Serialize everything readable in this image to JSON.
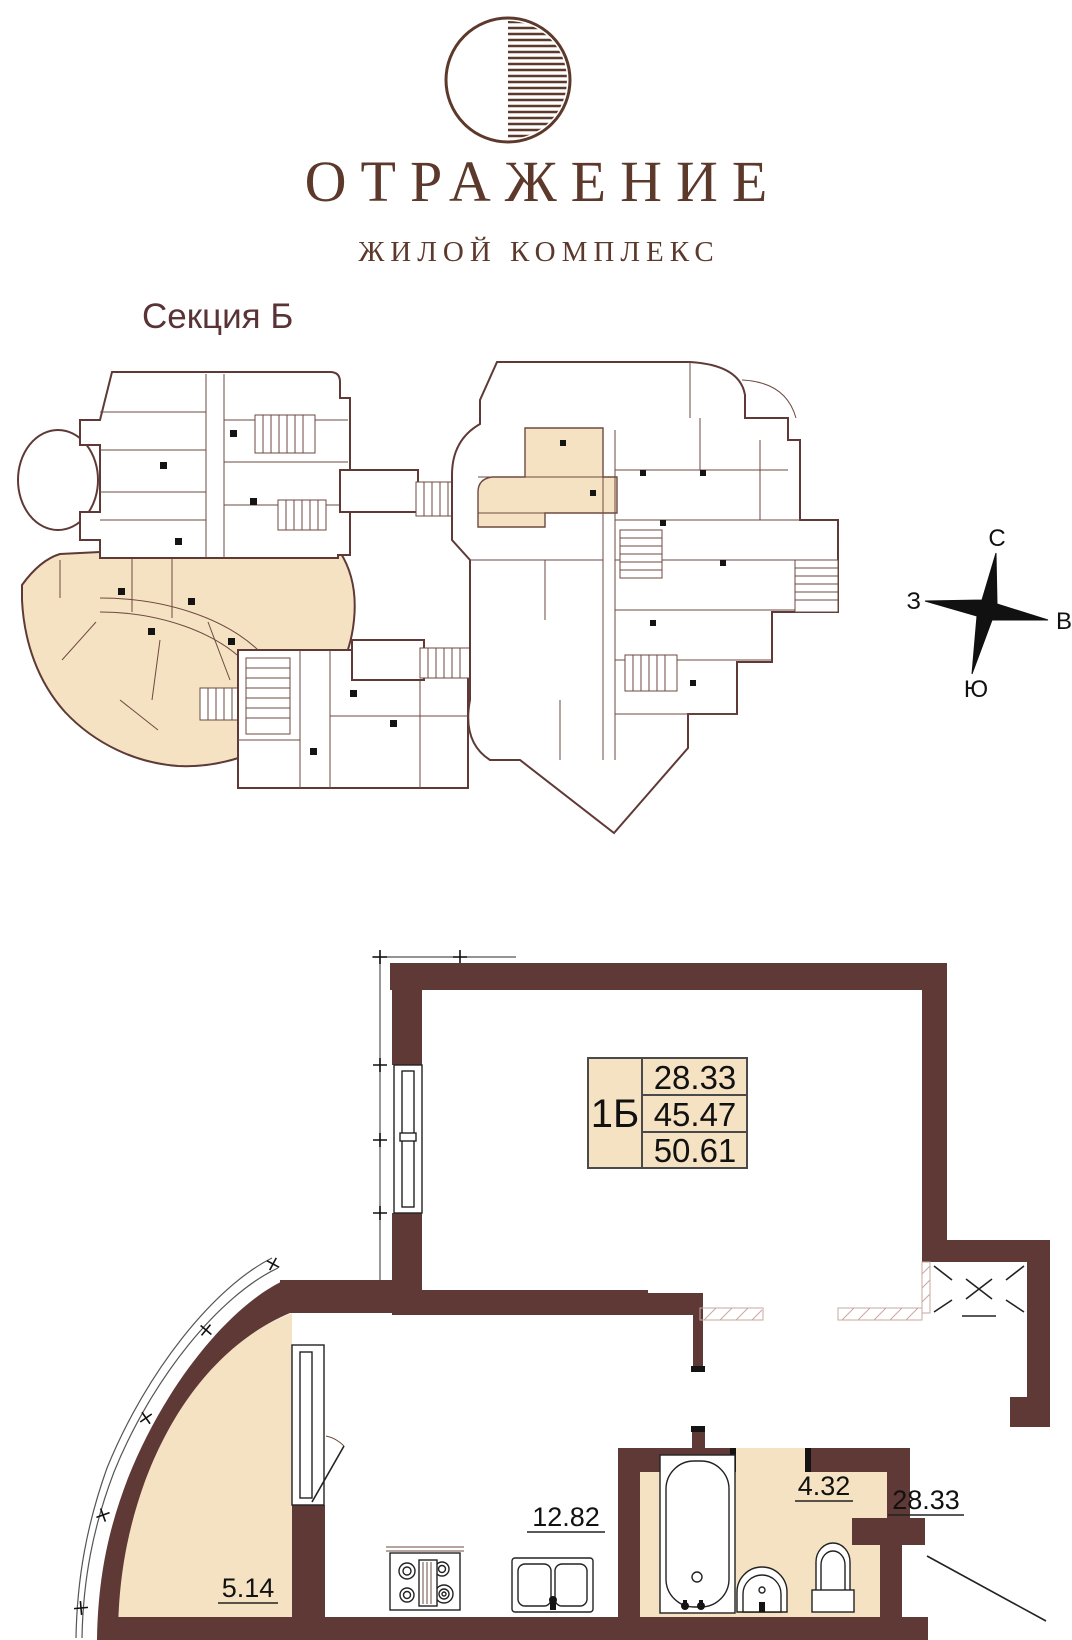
{
  "brand": {
    "title": "ОТРАЖЕНИЕ",
    "subtitle": "ЖИЛОЙ КОМПЛЕКС"
  },
  "section": {
    "label": "Секция Б"
  },
  "compass": {
    "north": "С",
    "east": "В",
    "south": "Ю",
    "west": "З"
  },
  "unit_card": {
    "unit": "1Б",
    "rows": [
      "28.33",
      "45.47",
      "50.61"
    ]
  },
  "rooms": {
    "balcony": "5.14",
    "kitchen": "12.82",
    "bathroom": "4.32",
    "living": "28.33"
  },
  "colors": {
    "wall": "#5e3936",
    "highlight": "#f5e2c3",
    "brand": "#5d392c"
  }
}
